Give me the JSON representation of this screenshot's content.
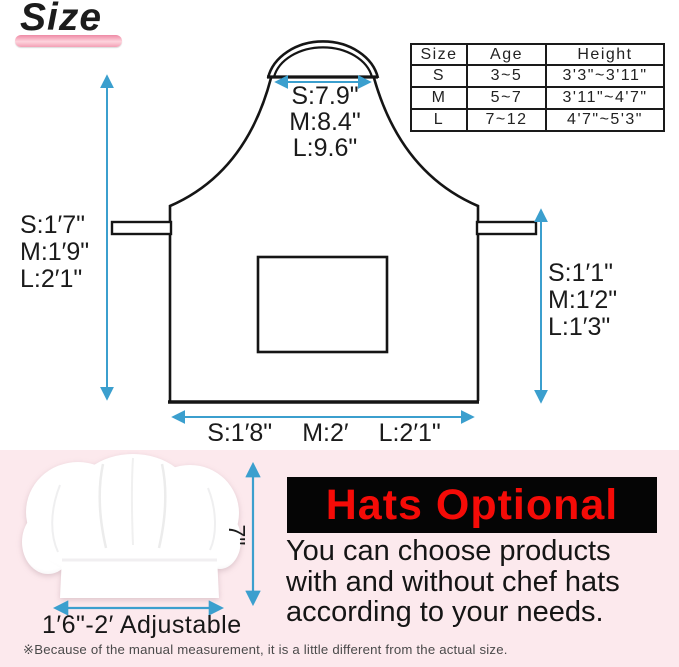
{
  "title": "Size",
  "colors": {
    "arrow_accent": "#3b9fce",
    "pink_bar": "#f3a0b5",
    "section_pink_bg": "#fce9ed",
    "optional_red": "#f50b07",
    "optional_bg": "#050505"
  },
  "size_table": {
    "headers": [
      "Size",
      "Age",
      "Height"
    ],
    "rows": [
      [
        "S",
        "3~5",
        "3'3\"~3'11\""
      ],
      [
        "M",
        "5~7",
        "3'11\"~4'7\""
      ],
      [
        "L",
        "7~12",
        "4'7\"~5'3\""
      ]
    ]
  },
  "apron_labels": {
    "neck_width": [
      "S:7.9\"",
      "M:8.4\"",
      "L:9.6\""
    ],
    "side_length_left": [
      "S:1′7\"",
      "M:1′9\"",
      "L:2′1\""
    ],
    "skirt_length_right": [
      "S:1′1\"",
      "M:1′2\"",
      "L:1′3\""
    ],
    "bottom_width": [
      "S:1′8\"",
      "M:2′",
      "L:2′1\""
    ]
  },
  "hat": {
    "height_label": "7\"",
    "band_label": "1′6\"-2′ Adjustable"
  },
  "hats_optional": {
    "title": "Hats Optional",
    "lines": [
      "You can choose products",
      "with and without chef hats",
      "according to your needs."
    ]
  },
  "footnote": "※Because of the manual measurement, it is a little different from the actual size."
}
